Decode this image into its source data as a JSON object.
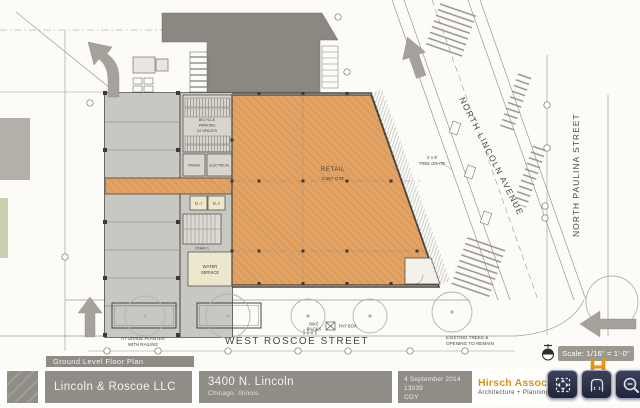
{
  "titleblock": {
    "sheet_label": "Ground Level Floor Plan",
    "client": "Lincoln & Roscoe LLC",
    "address_line1": "3400 N. Lincoln",
    "address_line2": "Chicago, Illinois",
    "date": "4 September 2014",
    "project_number": "13039",
    "author": "CGY",
    "firm_name": "Hirsch Associates",
    "firm_tagline": "Architecture + Planning",
    "logo_letter": "H"
  },
  "scale_bar": {
    "label": "Scale: 1/16\" = 1'-0\""
  },
  "streets": {
    "roscoe": "WEST ROSCOE STREET",
    "lincoln": "NORTH LINCOLN AVENUE",
    "paulina": "NORTH PAULINA STREET"
  },
  "rooms": {
    "retail": {
      "name": "RETAIL",
      "area": "3,567 GSF"
    },
    "bike": {
      "line1": "BICYCLE",
      "line2": "PARKING",
      "line3": "24 SPACES"
    },
    "trash": "TRASH",
    "electrical": "ELECTRICAL",
    "elevator_1": "EL-1",
    "elevator_2": "EL-2",
    "stair_1": "STAIR 1",
    "water": {
      "line1": "WATER",
      "line2": "SERVICE"
    }
  },
  "site_notes": {
    "bike_racks": {
      "line1": "BIKE",
      "line2": "RACKS"
    },
    "pay_box": "PAY BOX",
    "planter": {
      "line1": "AT GRADE PLANTER",
      "line2": "WITH RAILING"
    },
    "tree_grate": {
      "line1": "4' x 8'",
      "line2": "TREE GRATE"
    },
    "existing": {
      "line1": "EXISTING TREES &",
      "line2": "OPENING TO REMAIN"
    }
  },
  "viewer_toolbar": {
    "buttons": [
      {
        "name": "fit-screen"
      },
      {
        "name": "pan"
      },
      {
        "name": "zoom-out"
      }
    ],
    "chevrons": "‹ ›"
  },
  "colors": {
    "retail_fill": "#E2A263",
    "retail_hatch": "#C9854B",
    "parking_gray": "#C9C7C1",
    "adjacent_building": "#8B8882",
    "titlebar_gray": "#908D87",
    "firm_orange": "#E0910E",
    "toolbar_navy": "#262C3E",
    "room_cream": "#ECE7CD"
  }
}
